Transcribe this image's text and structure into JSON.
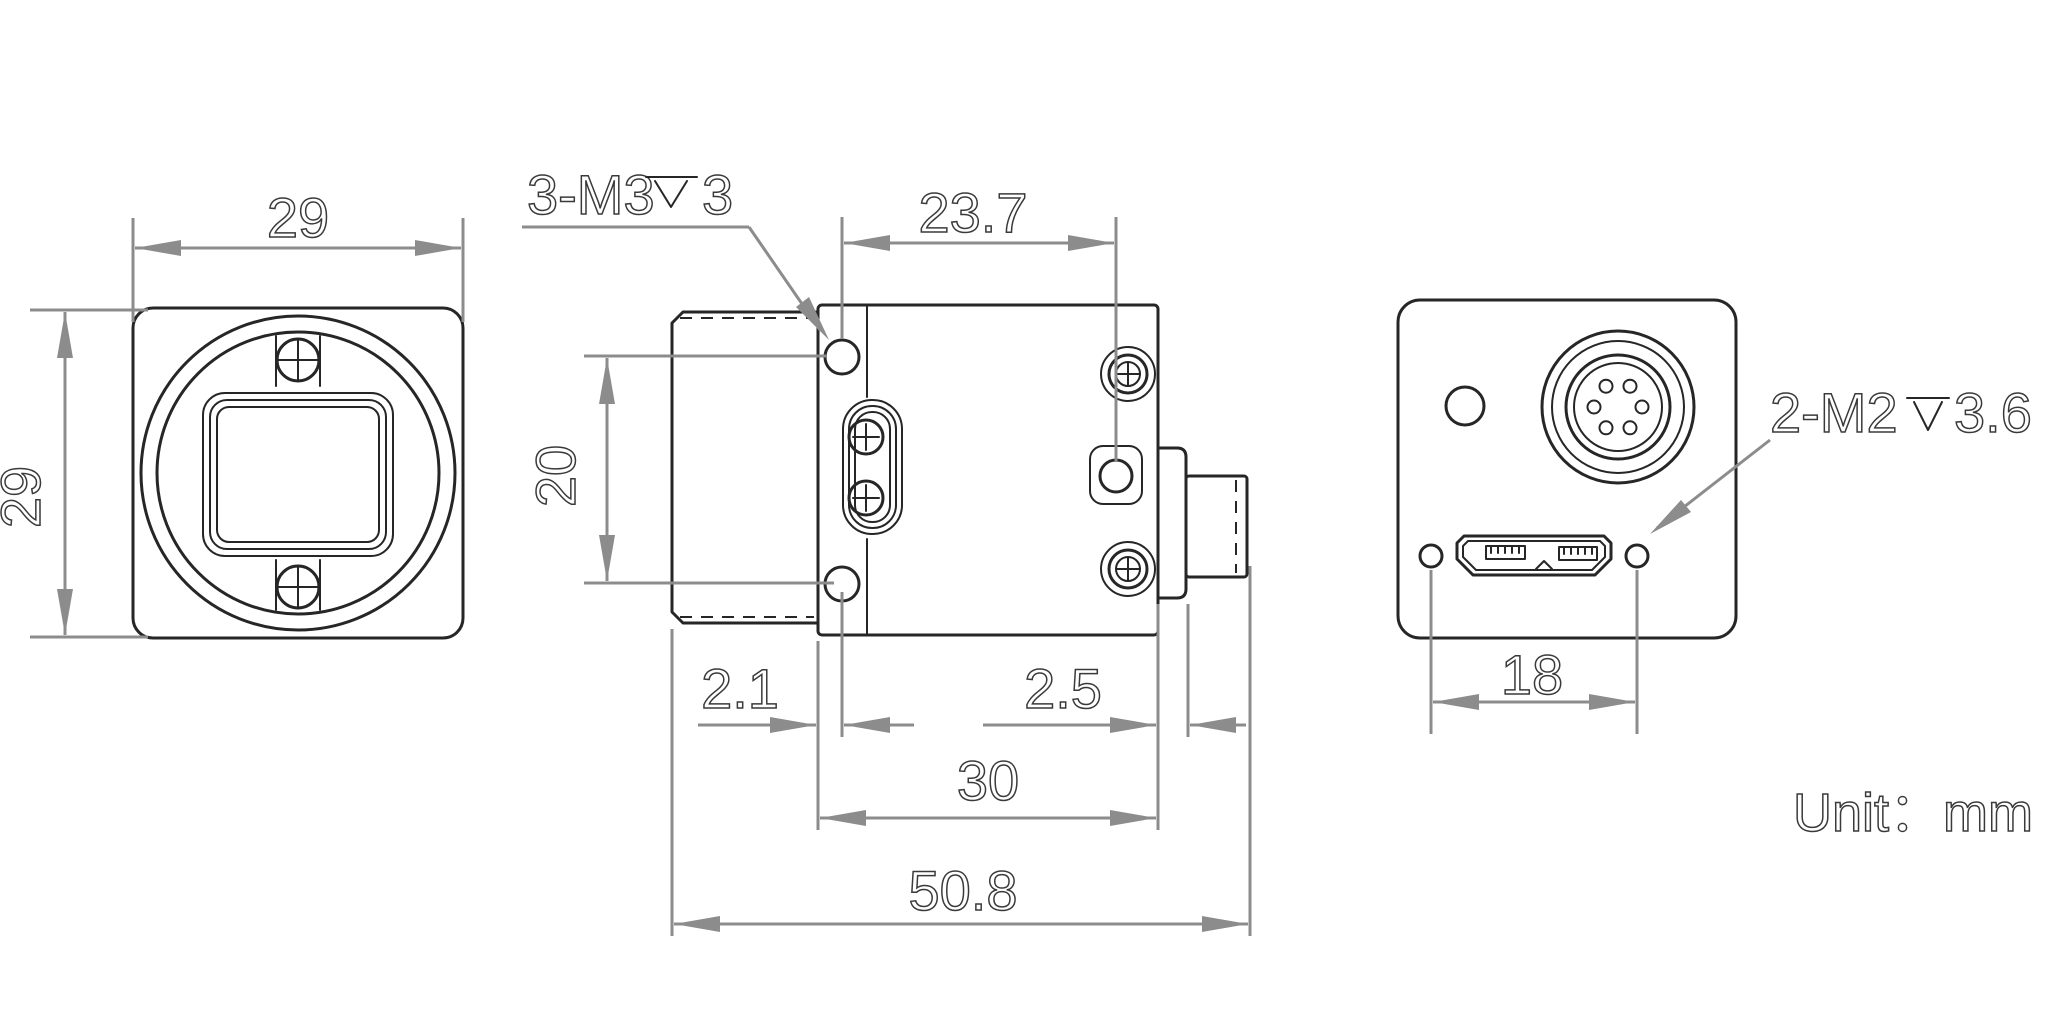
{
  "drawing": {
    "unit_label": "Unit：mm",
    "dims": {
      "front_width": "29",
      "front_height": "29",
      "side_hole_span": "23.7",
      "side_hole_vertical": "20",
      "side_front_offset": "2.1",
      "side_rear_plate": "2.5",
      "side_body_width": "30",
      "side_total_length": "50.8",
      "back_hole_span": "18"
    },
    "labels": {
      "side_thread": {
        "prefix": "3-M3",
        "depth_symbol": "↧",
        "suffix": "3"
      },
      "back_thread": {
        "prefix": "2-M2",
        "depth_symbol": "↧",
        "suffix": "3.6"
      }
    }
  }
}
